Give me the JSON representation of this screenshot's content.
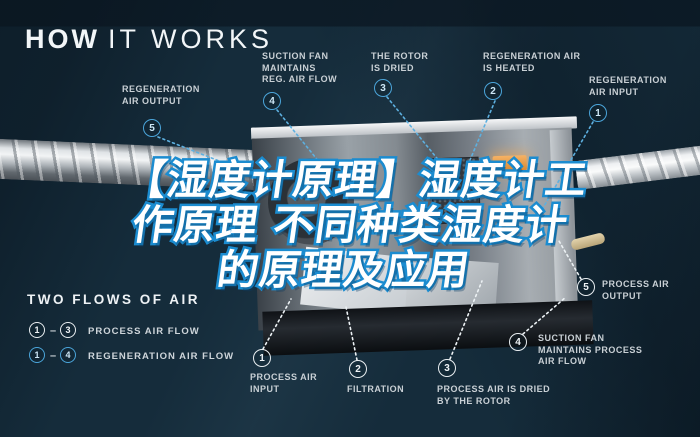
{
  "title": {
    "bold": "HOW",
    "light": "IT WORKS"
  },
  "colors": {
    "background": "#152c3b",
    "accent_blue": "#4ba5da",
    "circle_white": "#e9eef1",
    "headline_fill": "#ffffff",
    "headline_stroke": "#1b8cd0",
    "heater_orange": "#e89a44"
  },
  "headline": {
    "line1": "【湿度计原理】湿度计工",
    "line2": "作原理 不同种类湿度计",
    "line3": "的原理及应用"
  },
  "callouts": {
    "regeneration": [
      {
        "num": "5",
        "label": "REGENERATION\nAIR OUTPUT"
      },
      {
        "num": "4",
        "label": "SUCTION FAN\nMAINTAINS\nREG. AIR FLOW"
      },
      {
        "num": "3",
        "label": "THE ROTOR\nIS DRIED"
      },
      {
        "num": "2",
        "label": "REGENERATION AIR\nIS HEATED"
      },
      {
        "num": "1",
        "label": "REGENERATION\nAIR INPUT"
      }
    ],
    "process": [
      {
        "num": "1",
        "label": "PROCESS AIR\nINPUT"
      },
      {
        "num": "2",
        "label": "FILTRATION"
      },
      {
        "num": "3",
        "label": "PROCESS AIR IS DRIED\nBY THE ROTOR"
      },
      {
        "num": "4",
        "label": "SUCTION FAN\nMAINTAINS PROCESS\nAIR FLOW"
      },
      {
        "num": "5",
        "label": "PROCESS AIR\nOUTPUT"
      }
    ]
  },
  "legend": {
    "title": "TWO FLOWS OF AIR",
    "rows": [
      {
        "from": "1",
        "dash": "–",
        "to": "3",
        "label": "PROCESS AIR FLOW",
        "style": "white"
      },
      {
        "from": "1",
        "dash": "–",
        "to": "4",
        "label": "REGENERATION AIR FLOW",
        "style": "blue"
      }
    ]
  }
}
